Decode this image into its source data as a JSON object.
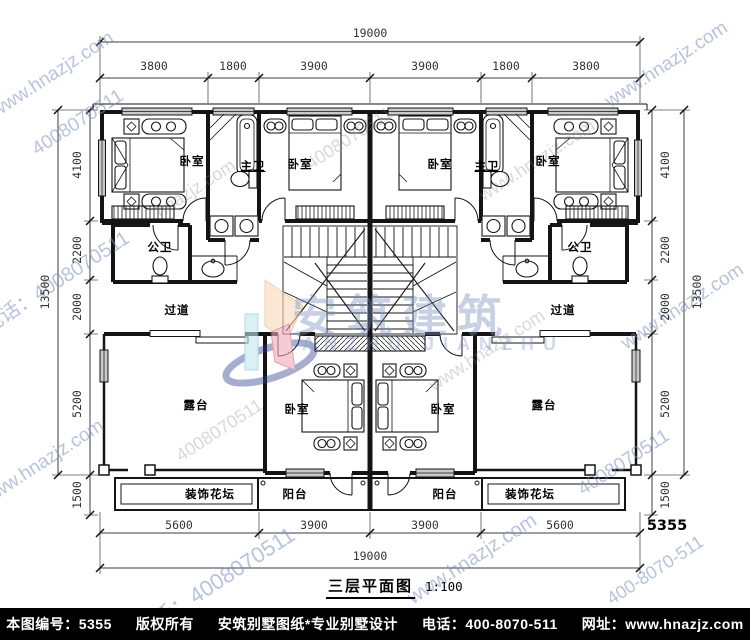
{
  "title": {
    "text": "三层平面图",
    "scale": "1:100"
  },
  "footer": {
    "items": [
      "本图编号：5355",
      "版权所有",
      "安筑别墅图纸*专业别墅设计",
      "电话：400-8070-511",
      "网址：www.hnazjz.com"
    ]
  },
  "logo": {
    "name": "安筑建筑",
    "latin": "ANZHU JIANZHU"
  },
  "room_labels": [
    "卧室",
    "主卫",
    "卧室",
    "卧室",
    "主卫",
    "卧室",
    "公卫",
    "公卫",
    "过道",
    "过道",
    "露台",
    "卧室",
    "卧室",
    "露台",
    "装饰花坛",
    "阳台",
    "阳台",
    "装饰花坛"
  ],
  "dimensions": {
    "top_total": "19000",
    "top_segments": [
      "3800",
      "1800",
      "3900",
      "3900",
      "1800",
      "3800"
    ],
    "bottom_segments": [
      "5600",
      "3900",
      "3900",
      "5600"
    ],
    "bottom_total": "19000",
    "left_segments": [
      "4100",
      "2200",
      "2000",
      "5200",
      "1500"
    ],
    "left_total": "13500",
    "right_segments": [
      "4100",
      "2200",
      "2000",
      "5200",
      "1500"
    ],
    "right_total": "13500",
    "sheet_number": "5355"
  },
  "watermarks": [
    "www.hnazjz.com",
    "4008070511",
    "www.hnazjz.com",
    "电话：4008070511",
    "www.hnazjz.com",
    "电话：4008070511",
    "www.hnazjz.com",
    "4008070511",
    "www.hnazjz.com",
    "400-8070-511",
    "hnazjz.com",
    "4008070511",
    "www.hnazjz.com",
    "4008070511",
    "www.hnazjz.com"
  ],
  "colors": {
    "wall": "#141414",
    "dim_line": "#3c3c3c",
    "window_fill": "#c9c9c9",
    "watermark_blue": "#7c8fc0",
    "logo_blue": "#7a92bc",
    "footer_bg": "#000000"
  }
}
